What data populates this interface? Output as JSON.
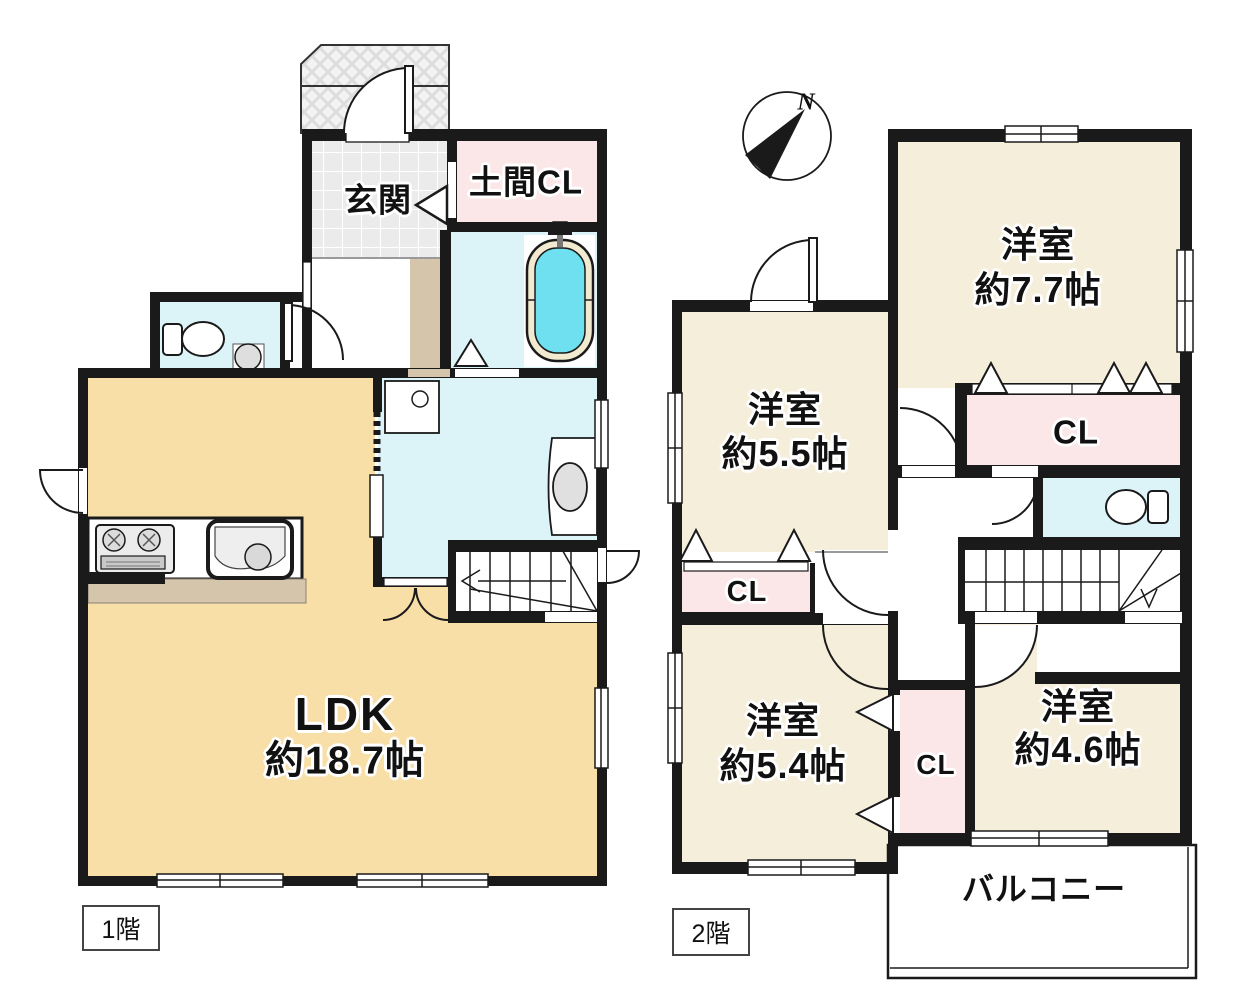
{
  "document": {
    "type": "floor-plan"
  },
  "colors": {
    "wall": "#1a1a1a",
    "ldk_floor": "#f7dfa7",
    "bedroom_floor": "#f5eedb",
    "closet_pink": "#fbe7e7",
    "wet_area_cyan": "#dcf4f8",
    "bathtub_aqua": "#6ee0ef",
    "entrance_tile_gray": "#ebebeb",
    "wood_step_tan": "#d5c5ab"
  },
  "compass": {
    "north_label": "N"
  },
  "floor1": {
    "floor_label": "1階",
    "entrance": {
      "name": "玄関"
    },
    "doma_closet": {
      "name": "土間CL"
    },
    "ldk": {
      "name": "LDK",
      "size": "約18.7帖"
    }
  },
  "floor2": {
    "floor_label": "2階",
    "room_7_7": {
      "name": "洋室",
      "size": "約7.7帖"
    },
    "closet_7_7": {
      "name": "CL"
    },
    "room_5_5": {
      "name": "洋室",
      "size": "約5.5帖"
    },
    "closet_5_5": {
      "name": "CL"
    },
    "room_5_4": {
      "name": "洋室",
      "size": "約5.4帖"
    },
    "closet_center": {
      "name": "CL"
    },
    "room_4_6": {
      "name": "洋室",
      "size": "約4.6帖"
    },
    "balcony": {
      "name": "バルコニー"
    }
  }
}
